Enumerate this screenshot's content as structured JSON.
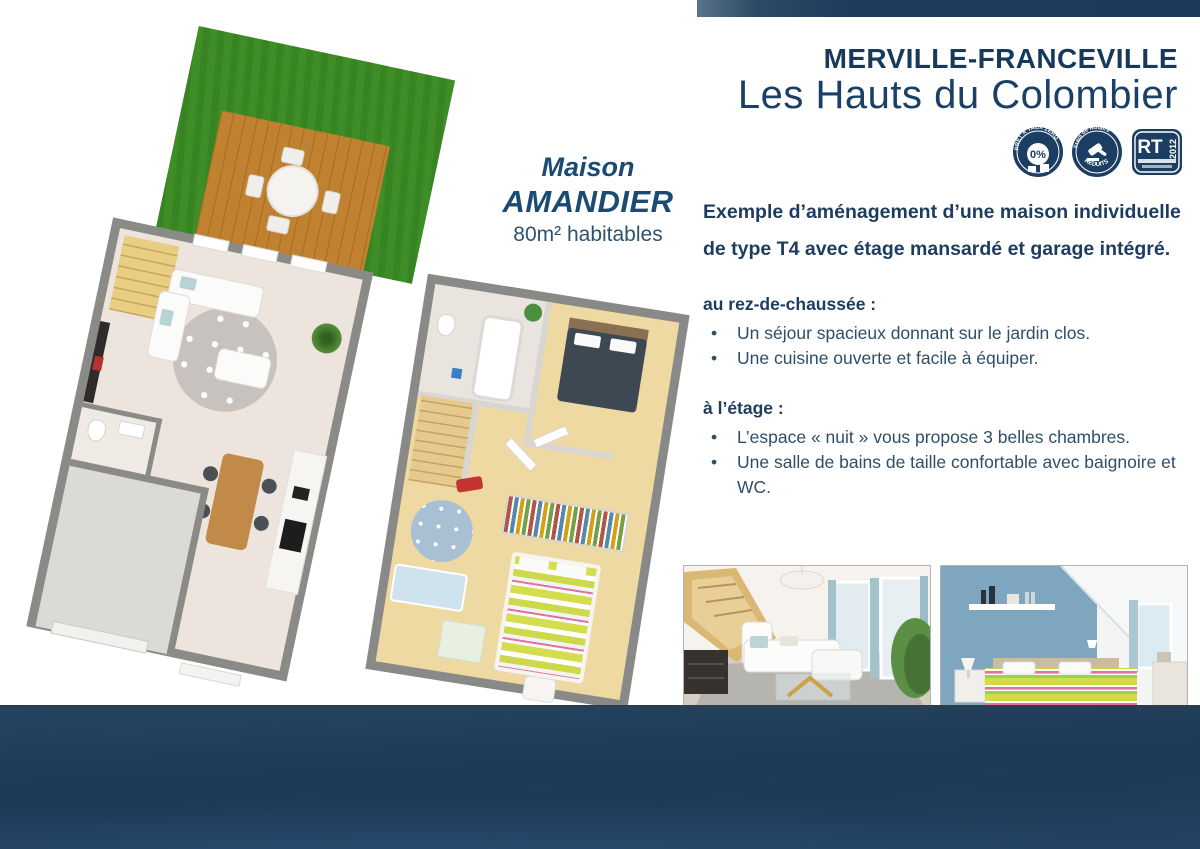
{
  "header": {
    "location_title": "MERVILLE-FRANCEVILLE",
    "program_title": "Les Hauts du Colombier"
  },
  "badges": [
    {
      "name": "pret-a-taux-zero",
      "ring_text": "PRÊT À TAUX ZÉRO",
      "center_text": "0%"
    },
    {
      "name": "frais-de-notaire",
      "top_text": "Frais de Notaire",
      "bottom_text": "RÉDUITS"
    },
    {
      "name": "rt-2012",
      "main_text": "RT",
      "side_text": "2012"
    }
  ],
  "plan_label": {
    "line1": "Maison",
    "line2": "AMANDIER",
    "line3": "80m² habitables"
  },
  "description": {
    "intro_line1": "Exemple d’aménagement d’une maison individuelle",
    "intro_line2": "de type T4 avec étage mansardé et garage intégré.",
    "sections": [
      {
        "heading": "au rez-de-chaussée :",
        "items": [
          "Un séjour spacieux donnant sur le jardin clos.",
          "Une cuisine ouverte et facile à équiper."
        ]
      },
      {
        "heading": "à l’étage :",
        "items": [
          "L’espace « nuit » vous propose 3 belles chambres.",
          "Une salle de bains de taille confortable avec baignoire et WC."
        ]
      }
    ]
  },
  "photos": [
    {
      "label": "living-room-interior-render"
    },
    {
      "label": "bedroom-interior-render"
    }
  ],
  "colors": {
    "navy_title": "#17395c",
    "navy_footer": "#1f3b59",
    "garden_green": "#3e8d26",
    "deck_wood": "#c08130",
    "wall_gray": "#8a8a87"
  }
}
